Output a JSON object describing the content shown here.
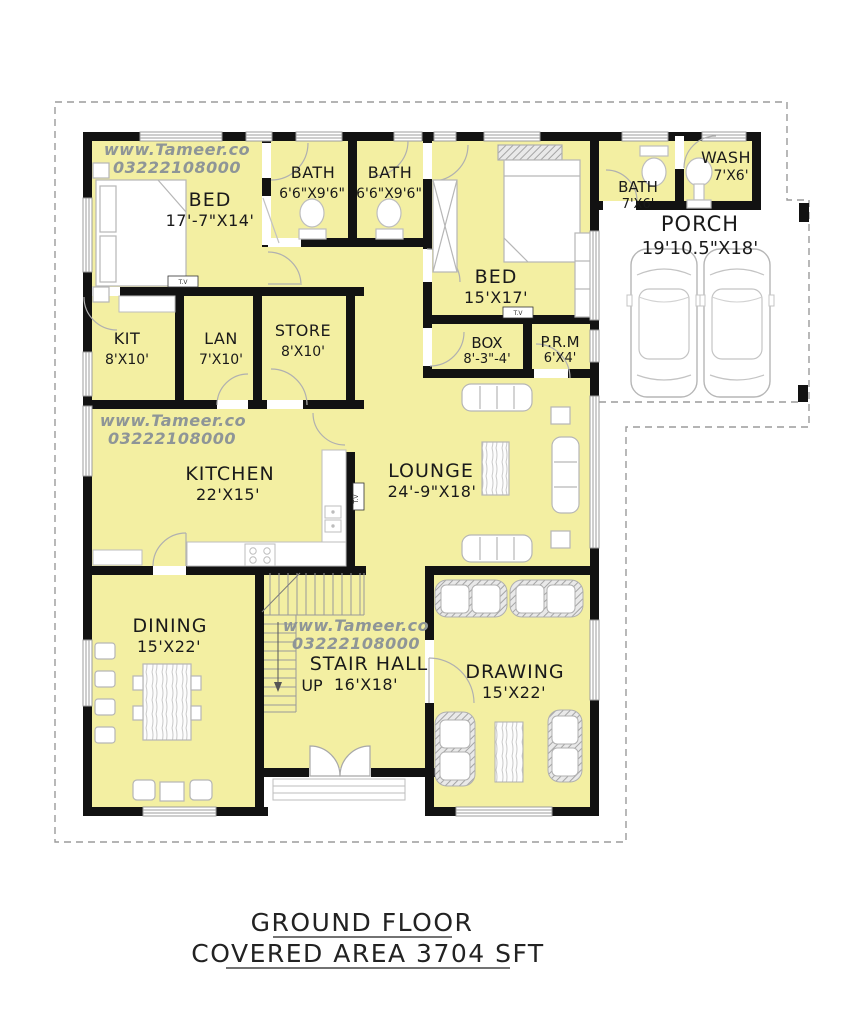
{
  "title": {
    "line1": "GROUND FLOOR",
    "line2": "COVERED AREA 3704 SFT"
  },
  "watermark": {
    "site": "www.Tameer.co",
    "phone": "03222108000"
  },
  "labels": {
    "up": "UP",
    "tv": "T.V"
  },
  "rooms": {
    "bed1": {
      "name": "BED",
      "dims": "17'-7\"X14'"
    },
    "bath1": {
      "name": "BATH",
      "dims": "6'6\"X9'6\""
    },
    "bath2": {
      "name": "BATH",
      "dims": "6'6\"X9'6\""
    },
    "bed2": {
      "name": "BED",
      "dims": "15'X17'"
    },
    "bath3": {
      "name": "BATH",
      "dims": "7'X6'"
    },
    "wash": {
      "name": "WASH",
      "dims": "7'X6'"
    },
    "porch": {
      "name": "PORCH",
      "dims": "19'10.5\"X18'"
    },
    "kit": {
      "name": "KIT",
      "dims": "8'X10'"
    },
    "lan": {
      "name": "LAN",
      "dims": "7'X10'"
    },
    "store": {
      "name": "STORE",
      "dims": "8'X10'"
    },
    "box": {
      "name": "BOX",
      "dims": "8'-3\"-4'"
    },
    "prm": {
      "name": "P.R.M",
      "dims": "6'X4'"
    },
    "kitchen": {
      "name": "KITCHEN",
      "dims": "22'X15'"
    },
    "lounge": {
      "name": "LOUNGE",
      "dims": "24'-9\"X18'"
    },
    "dining": {
      "name": "DINING",
      "dims": "15'X22'"
    },
    "stair_hall": {
      "name": "STAIR HALL",
      "dims": "16'X18'"
    },
    "drawing": {
      "name": "DRAWING",
      "dims": "15'X22'"
    }
  },
  "colors": {
    "floor_fill": "#f3efa2",
    "wall": "#121212",
    "watermark": "#8e9597",
    "boundary": "#9b9b9b"
  }
}
